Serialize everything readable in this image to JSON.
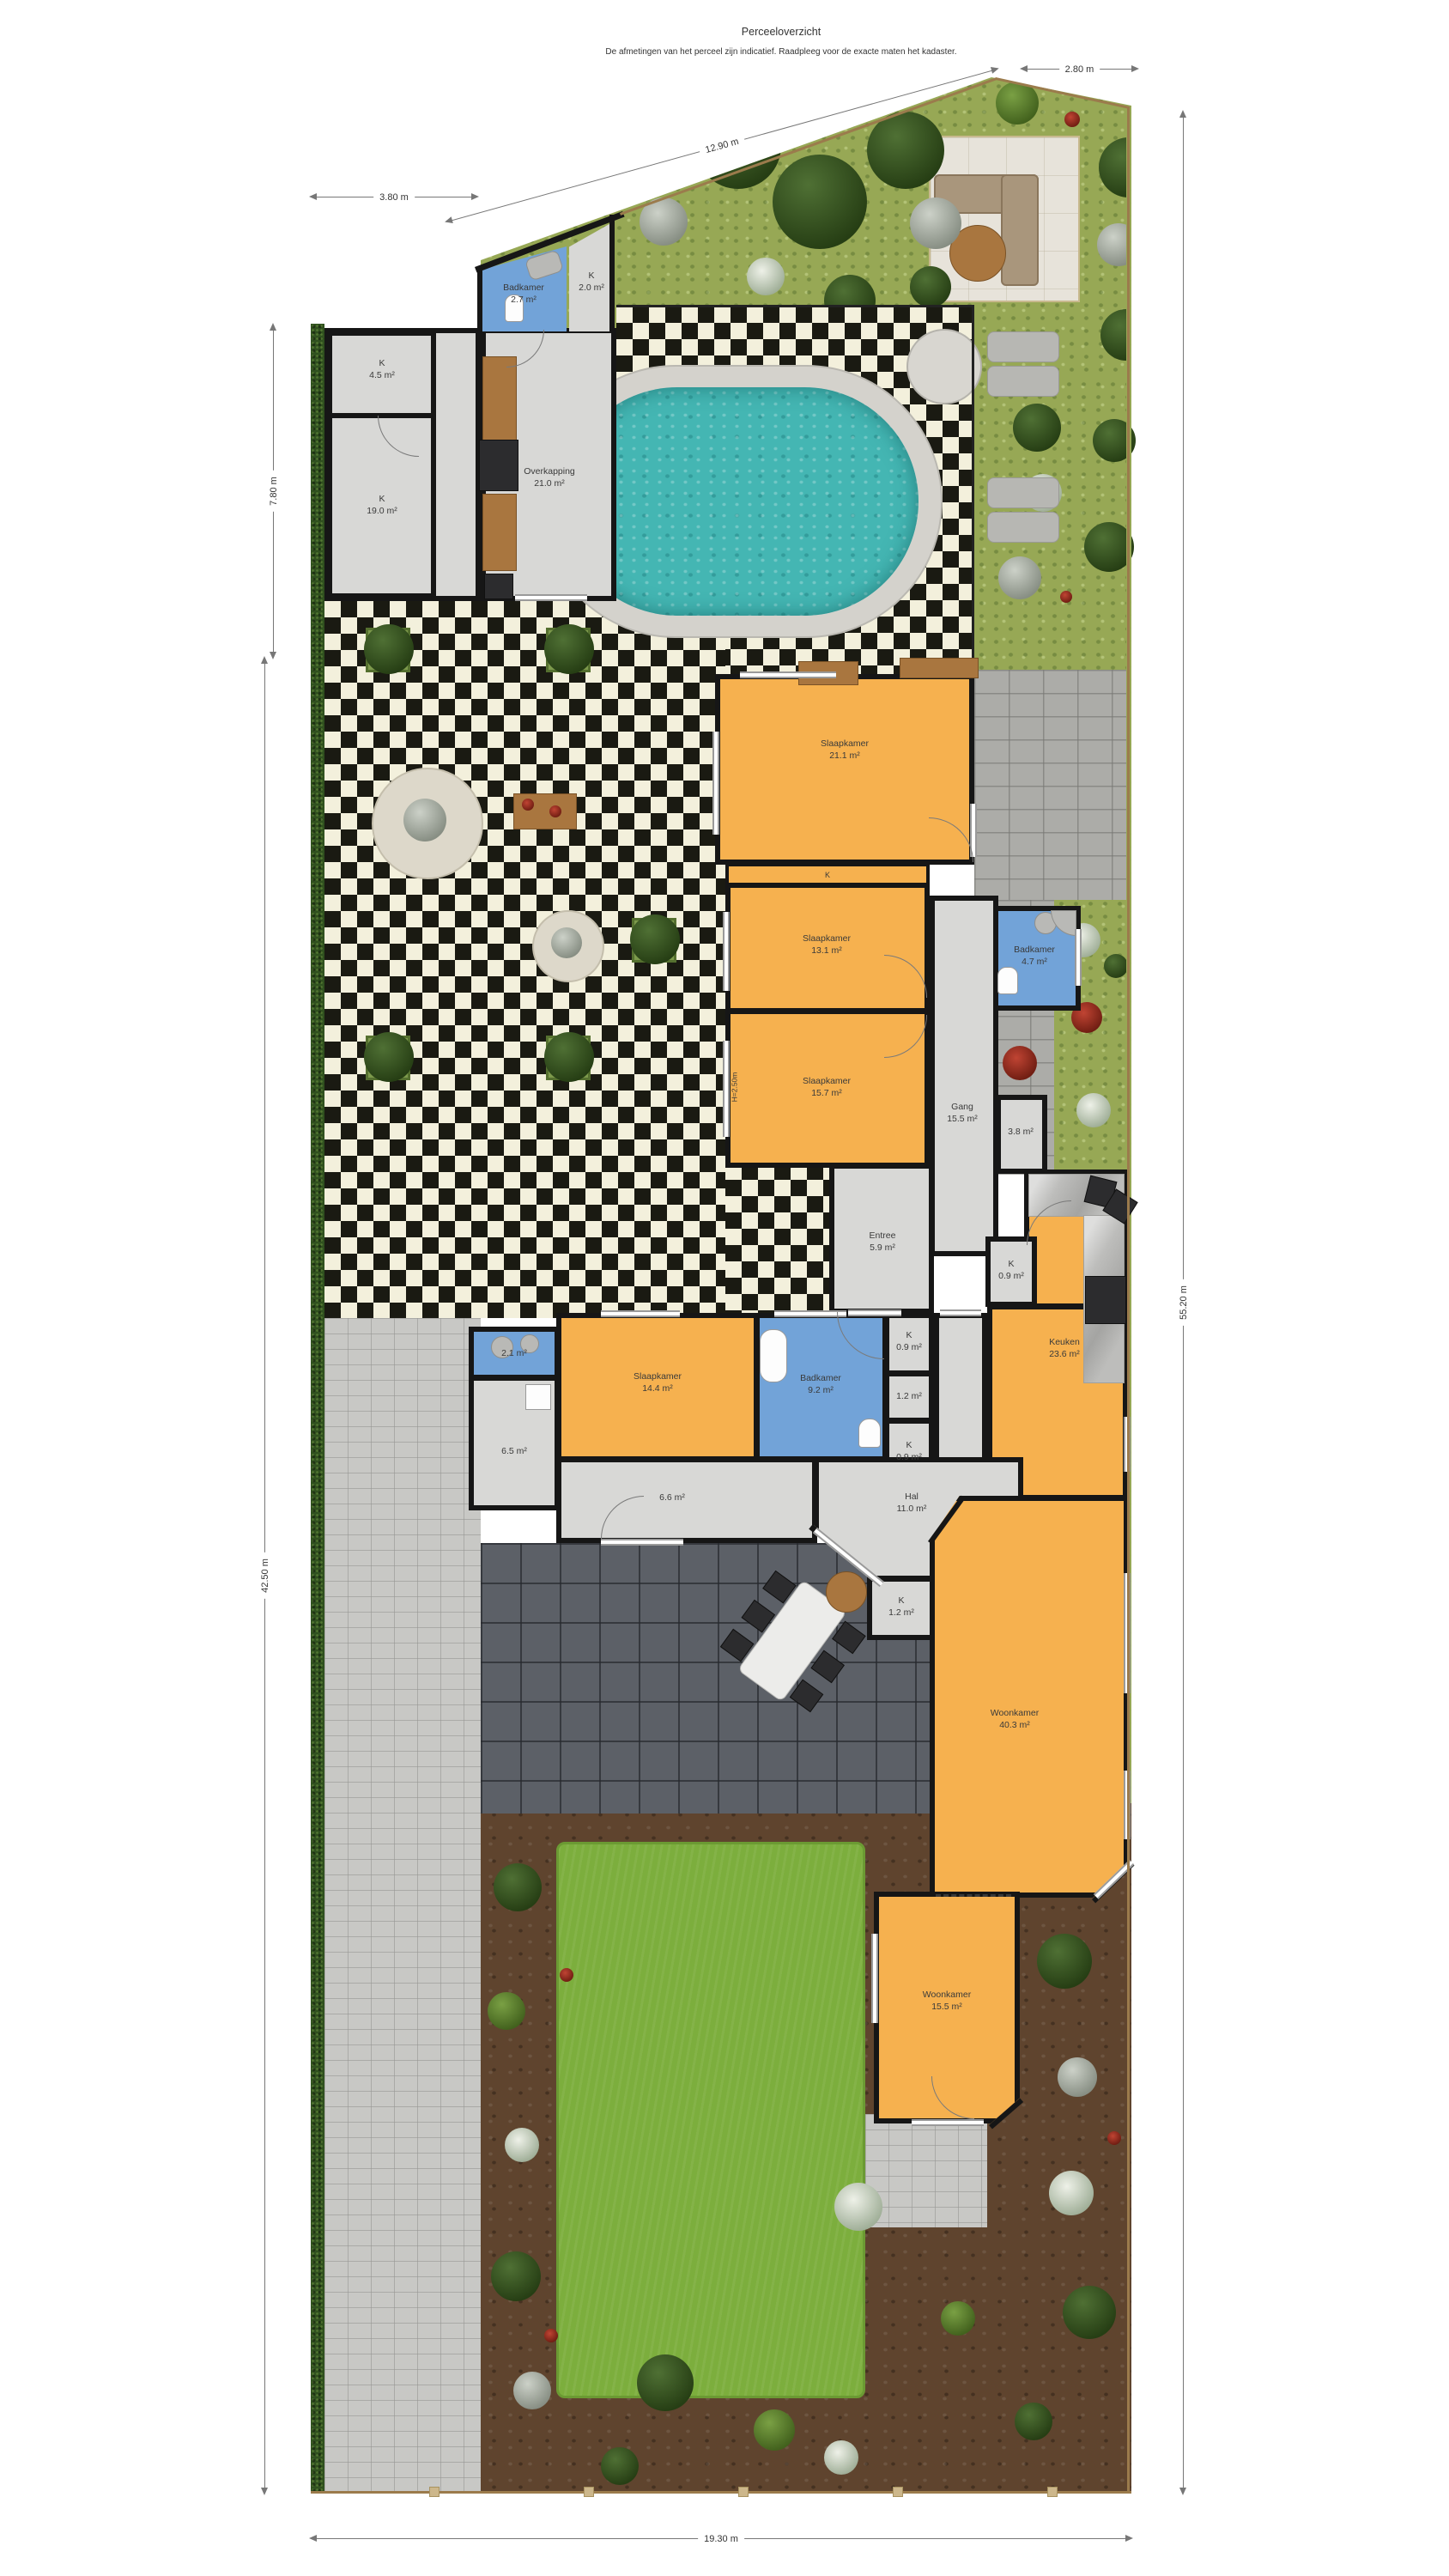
{
  "header": {
    "title": "Perceeloverzicht",
    "subtitle": "De afmetingen van het perceel zijn indicatief. Raadpleeg voor de exacte maten het kadaster."
  },
  "dims": {
    "top_left": "3.80 m",
    "top_diagonal": "12.90 m",
    "top_right": "2.80 m",
    "left_upper": "7.80 m",
    "left_lower": "42.50 m",
    "right_side": "55.20 m",
    "bottom": "19.30 m"
  },
  "rooms": {
    "badkamer_top": {
      "name": "Badkamer",
      "area": "2.7 m²"
    },
    "kast_top": {
      "name": "K",
      "area": "2.0 m²"
    },
    "berging_klein": {
      "name": "K",
      "area": "4.5 m²"
    },
    "garage": {
      "name": "K",
      "area": "19.0 m²"
    },
    "overkapping": {
      "name": "Overkapping",
      "area": "21.0 m²"
    },
    "slaapkamer1": {
      "name": "Slaapkamer",
      "area": "21.1 m²"
    },
    "kast_strip": {
      "name": "K"
    },
    "slaapkamer2": {
      "name": "Slaapkamer",
      "area": "13.1 m²"
    },
    "badkamer1": {
      "name": "Badkamer",
      "area": "4.7 m²"
    },
    "slaapkamer3": {
      "name": "Slaapkamer",
      "area": "15.7 m²",
      "height_note": "H=2.50m"
    },
    "gang": {
      "name": "Gang",
      "area": "15.5 m²"
    },
    "berging": {
      "area": "3.8 m²"
    },
    "entree": {
      "name": "Entree",
      "area": "5.9 m²"
    },
    "kast_keuken": {
      "name": "K",
      "area": "0.9 m²"
    },
    "keuken": {
      "name": "Keuken",
      "area": "23.6 m²"
    },
    "kast_a": {
      "name": "K",
      "area": "0.9 m²"
    },
    "tussenkast": {
      "area": "1.2 m²"
    },
    "kast_b": {
      "name": "K",
      "area": "0.9 m²"
    },
    "toilet": {
      "area": "2.1 m²"
    },
    "werkkast": {
      "area": "6.5 m²"
    },
    "slaapkamer4": {
      "name": "Slaapkamer",
      "area": "14.4 m²"
    },
    "badkamer2": {
      "name": "Badkamer",
      "area": "9.2 m²"
    },
    "gang2": {
      "area": "6.6 m²"
    },
    "hal": {
      "name": "Hal",
      "area": "11.0 m²"
    },
    "kast_hal": {
      "name": "K",
      "area": "1.2 m²"
    },
    "woonkamer1": {
      "name": "Woonkamer",
      "area": "40.3 m²"
    },
    "woonkamer2": {
      "name": "Woonkamer",
      "area": "15.5 m²"
    }
  },
  "colors": {
    "bedroom": "#f6b14f",
    "bathroom": "#72a3d8",
    "floor": "#d8d8d6",
    "wall": "#161616",
    "pool_water": "#44b6b3",
    "lawn": "#7cae3d",
    "hedge": "#30511f",
    "checker_dark": "#1a1a12",
    "checker_light": "#f3f0dc"
  }
}
